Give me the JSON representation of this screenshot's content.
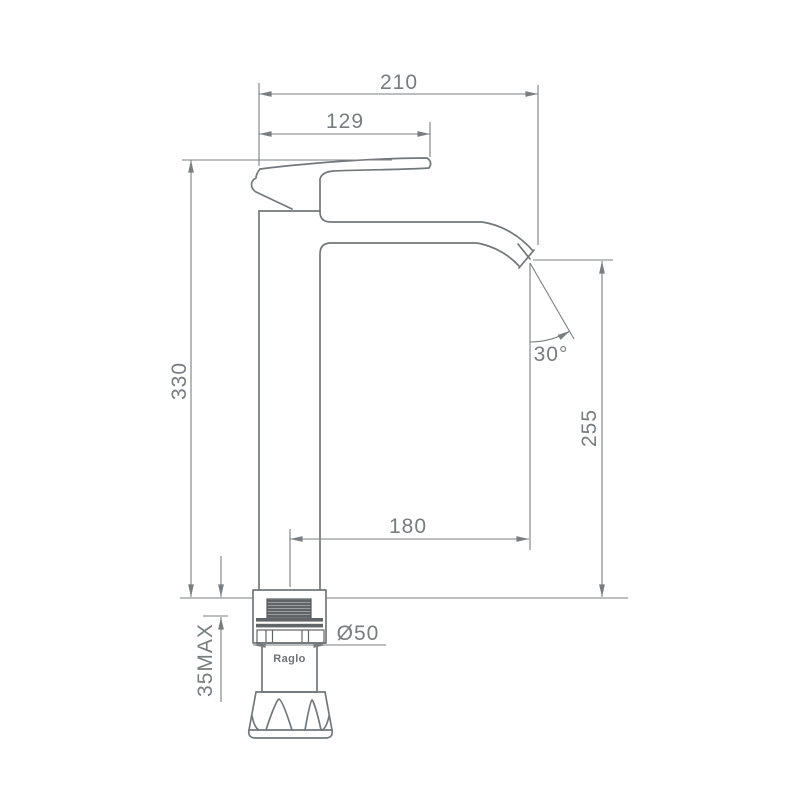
{
  "page": {
    "background_color": "#ffffff",
    "drawing_line_color": "#74777a",
    "dimension_color": "#7b7e81"
  },
  "drawing": {
    "brand": "Raglo",
    "dimensions": {
      "overall_reach": "210",
      "handle_reach": "129",
      "body_height": "330",
      "spout_height": "255",
      "spout_reach": "180",
      "spout_angle": "30°",
      "base_diameter": "Ø50",
      "deck_thickness": "35MAX"
    }
  }
}
